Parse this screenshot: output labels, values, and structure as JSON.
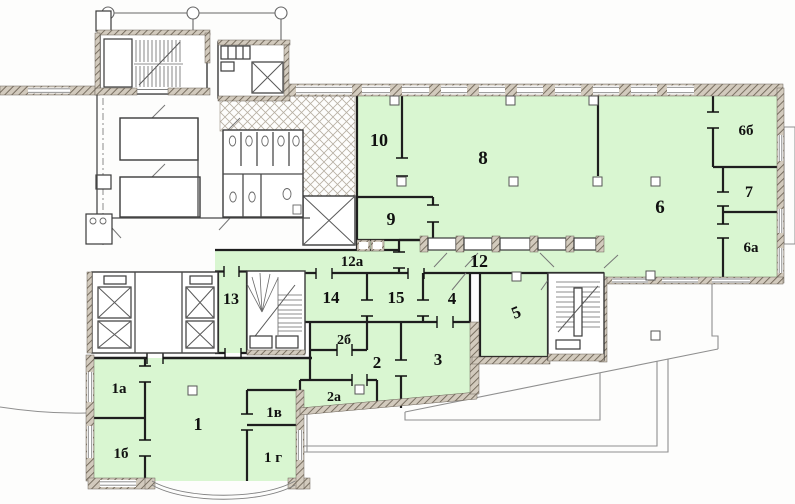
{
  "colors": {
    "room_fill": "#d9f6d1",
    "wall": "#1e1e1e",
    "exterior_hatch": "#cfc8bc",
    "site_line": "#8f8f8f"
  },
  "rooms": [
    {
      "id": "10",
      "label": "10"
    },
    {
      "id": "8",
      "label": "8"
    },
    {
      "id": "9",
      "label": "9"
    },
    {
      "id": "6",
      "label": "6"
    },
    {
      "id": "6b",
      "label": "6б"
    },
    {
      "id": "7",
      "label": "7"
    },
    {
      "id": "6a",
      "label": "6а"
    },
    {
      "id": "12a",
      "label": "12а"
    },
    {
      "id": "12",
      "label": "12"
    },
    {
      "id": "13",
      "label": "13"
    },
    {
      "id": "14",
      "label": "14"
    },
    {
      "id": "15",
      "label": "15"
    },
    {
      "id": "4",
      "label": "4"
    },
    {
      "id": "5",
      "label": "5"
    },
    {
      "id": "2b",
      "label": "2б"
    },
    {
      "id": "2",
      "label": "2"
    },
    {
      "id": "3",
      "label": "3"
    },
    {
      "id": "2a",
      "label": "2а"
    },
    {
      "id": "1a",
      "label": "1а"
    },
    {
      "id": "1",
      "label": "1"
    },
    {
      "id": "1b",
      "label": "1б"
    },
    {
      "id": "1v",
      "label": "1в"
    },
    {
      "id": "1g",
      "label": "1 г"
    }
  ]
}
